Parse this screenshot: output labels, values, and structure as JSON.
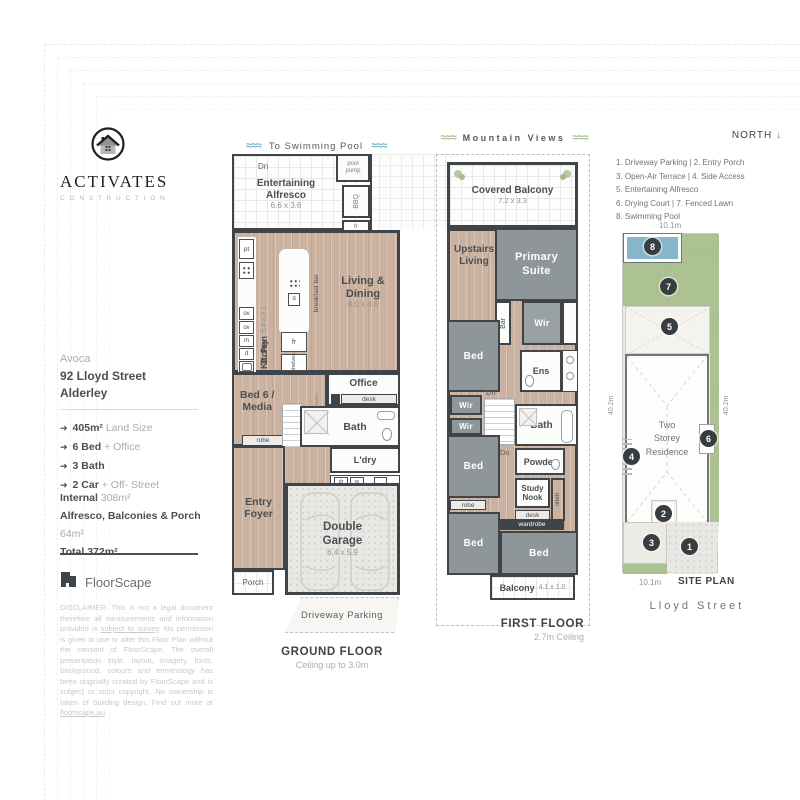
{
  "icons": {
    "waves": "≈≈≈",
    "north_arrow": "↓",
    "feature_arrow": "➔"
  },
  "sidebar": {
    "logo": {
      "name": "ACTIVATES",
      "sub": "C O N S T R U C T I O N"
    },
    "property": {
      "name": "Avoca",
      "street": "92 Lloyd Street",
      "suburb": "Alderley"
    },
    "features": [
      {
        "bold": "405m²",
        "rest": "Land Size"
      },
      {
        "bold": "6 Bed",
        "rest": "+ Office"
      },
      {
        "bold": "3 Bath",
        "rest": ""
      },
      {
        "bold": "2 Car",
        "rest": "+ Off- Street"
      }
    ],
    "areas": [
      {
        "label": "Internal",
        "value": "308m²"
      },
      {
        "label": "Alfresco, Balconies & Porch",
        "value": "64m²"
      },
      {
        "label": "Total 372m²",
        "value": ""
      }
    ],
    "brand": "FloorScape",
    "disclaimer": {
      "p1": "DISCLAIMER: This is not a legal document therefore all measurements and information provided is ",
      "u1": "subject to survey",
      "p2": ". No permission is given to use or alter this Floor Plan without the consent of FloorScape. The overall presentation style, layout, imagery, fonts, background, colours and terminology has been originally created by FloorScape and is subject to strict copyright. No ownership is taken of building design. Find out more at ",
      "u2": "floorscape.au"
    }
  },
  "ground_floor": {
    "header": "To Swimming Pool",
    "caption": "GROUND FLOOR",
    "caption_sub": "Ceiling up to 3.0m",
    "rooms": {
      "alfresco": {
        "name": "Entertaining\nAlfresco",
        "dims": "6.6 x 3.6"
      },
      "dn": "Dn",
      "pool_pump": "pool\npump",
      "bbq": "BBQ",
      "fr_alfresco": "fr",
      "pt": "pt",
      "ov1": "ov",
      "ov2": "ov",
      "m": "m",
      "d": "d",
      "kitchen": {
        "name": "Kitchen",
        "dims": "5.4 x 3.1"
      },
      "island_d": "d",
      "breakfast_bar": "breakfast bar",
      "bpty": "B. Pty",
      "fr": "fr",
      "shelves": "shelves",
      "living": {
        "name": "Living &\nDining",
        "dims": "8.0 x 4.6"
      },
      "office": "Office",
      "desk": "desk",
      "bed6": "Bed 6 /\nMedia",
      "robe": "robe",
      "to_below": "to below",
      "bath": "Bath",
      "up": "Up",
      "dn2": "Dn",
      "ldry": "L'dry",
      "dr": "dr",
      "w": "w",
      "lin": "lin",
      "mud": "mud",
      "store": "store",
      "entry": "Entry\nFoyer",
      "garage": {
        "name": "Double\nGarage",
        "dims": "6.4 x 5.9"
      },
      "porch": "Porch",
      "driveway": "Driveway Parking"
    }
  },
  "first_floor": {
    "header": "Mountain Views",
    "caption": "FIRST FLOOR",
    "caption_sub": "2.7m Ceiling",
    "rooms": {
      "covered_balcony": {
        "name": "Covered Balcony",
        "dims": "7.2 x 3.3"
      },
      "upstairs_living": "Upstairs\nLiving",
      "primary_suite": "Primary\nSuite",
      "bar": "Bar",
      "wir1": "Wir",
      "bed1": "Bed",
      "ens": "Ens",
      "wir2": "Wir",
      "wir3": "Wir",
      "dn1": "Dn",
      "dn2": "Dn",
      "bath": "Bath",
      "powder": "Powder",
      "bed2": "Bed",
      "study_nook": "Study\nNook",
      "desk": "desk",
      "linen": "linen",
      "robe": "robe",
      "wardrobe": "wardrobe",
      "bed3": "Bed",
      "bed4": "Bed",
      "balcony": {
        "name": "Balcony",
        "dims": "4.1 x 1.0"
      }
    }
  },
  "site_plan": {
    "north": "NORTH",
    "legend": [
      "1. Driveway Parking   |   2. Entry Porch",
      "3. Open-Air Terrace   |   4. Side Access",
      "5. Entertaining Alfresco",
      "6. Drying Court   |   7. Fenced Lawn",
      "8. Swimming Pool"
    ],
    "dims": {
      "top": "10.1m",
      "left": "40.2m",
      "right": "40.2m",
      "bottom": "10.1m"
    },
    "residence": "Two\nStorey\nResidence",
    "markers": [
      "1",
      "2",
      "3",
      "4",
      "5",
      "6",
      "7",
      "8"
    ],
    "caption": "SITE PLAN",
    "street": "Lloyd Street"
  },
  "colors": {
    "wall": "#3f4448",
    "timber": "#cbb19f",
    "carpet": "#8e969a",
    "lawn": "#abc191",
    "pool": "#85b7c9"
  }
}
